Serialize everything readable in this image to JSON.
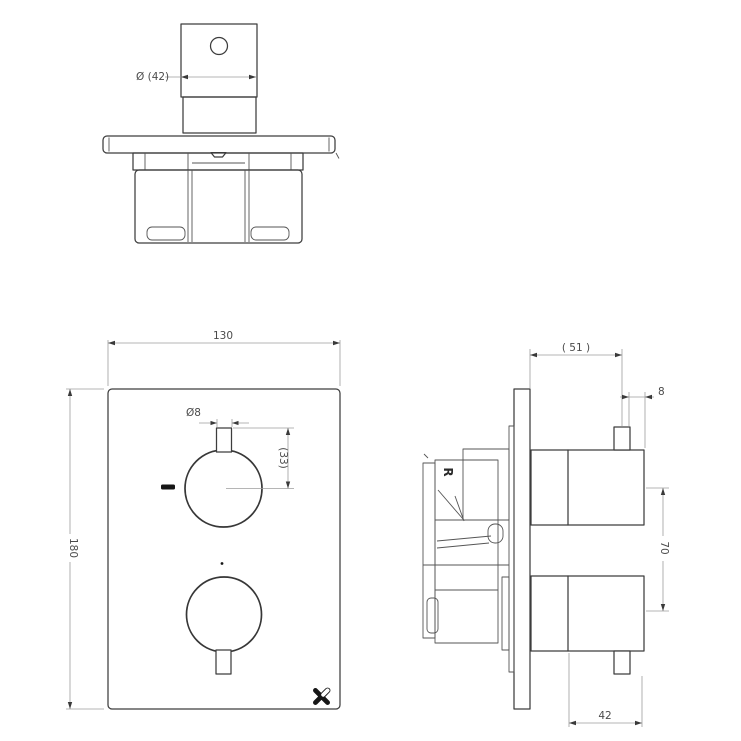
{
  "drawing": {
    "title": "thermostatic-shower-valve-technical-drawing",
    "colors": {
      "background": "#ffffff",
      "object_line": "#3d3d3d",
      "dimension_line": "#9c9c9c",
      "dimension_text": "#4b4b4b",
      "logo": "#161616"
    },
    "views": {
      "top": {
        "dims": {
          "handle_diameter": "Ø (42)"
        }
      },
      "front": {
        "dims": {
          "plate_width": "130",
          "plate_height": "180",
          "lever_diameter": "Ø8",
          "lever_to_center": "(33)"
        }
      },
      "side": {
        "dims": {
          "plate_to_lever": "( 51 )",
          "lever_beyond_knob": "8",
          "knob_centers": "70",
          "knob_depth": "42"
        },
        "body_mark": "R"
      }
    },
    "logo": {
      "icon": "crosswater-x-logo"
    }
  }
}
